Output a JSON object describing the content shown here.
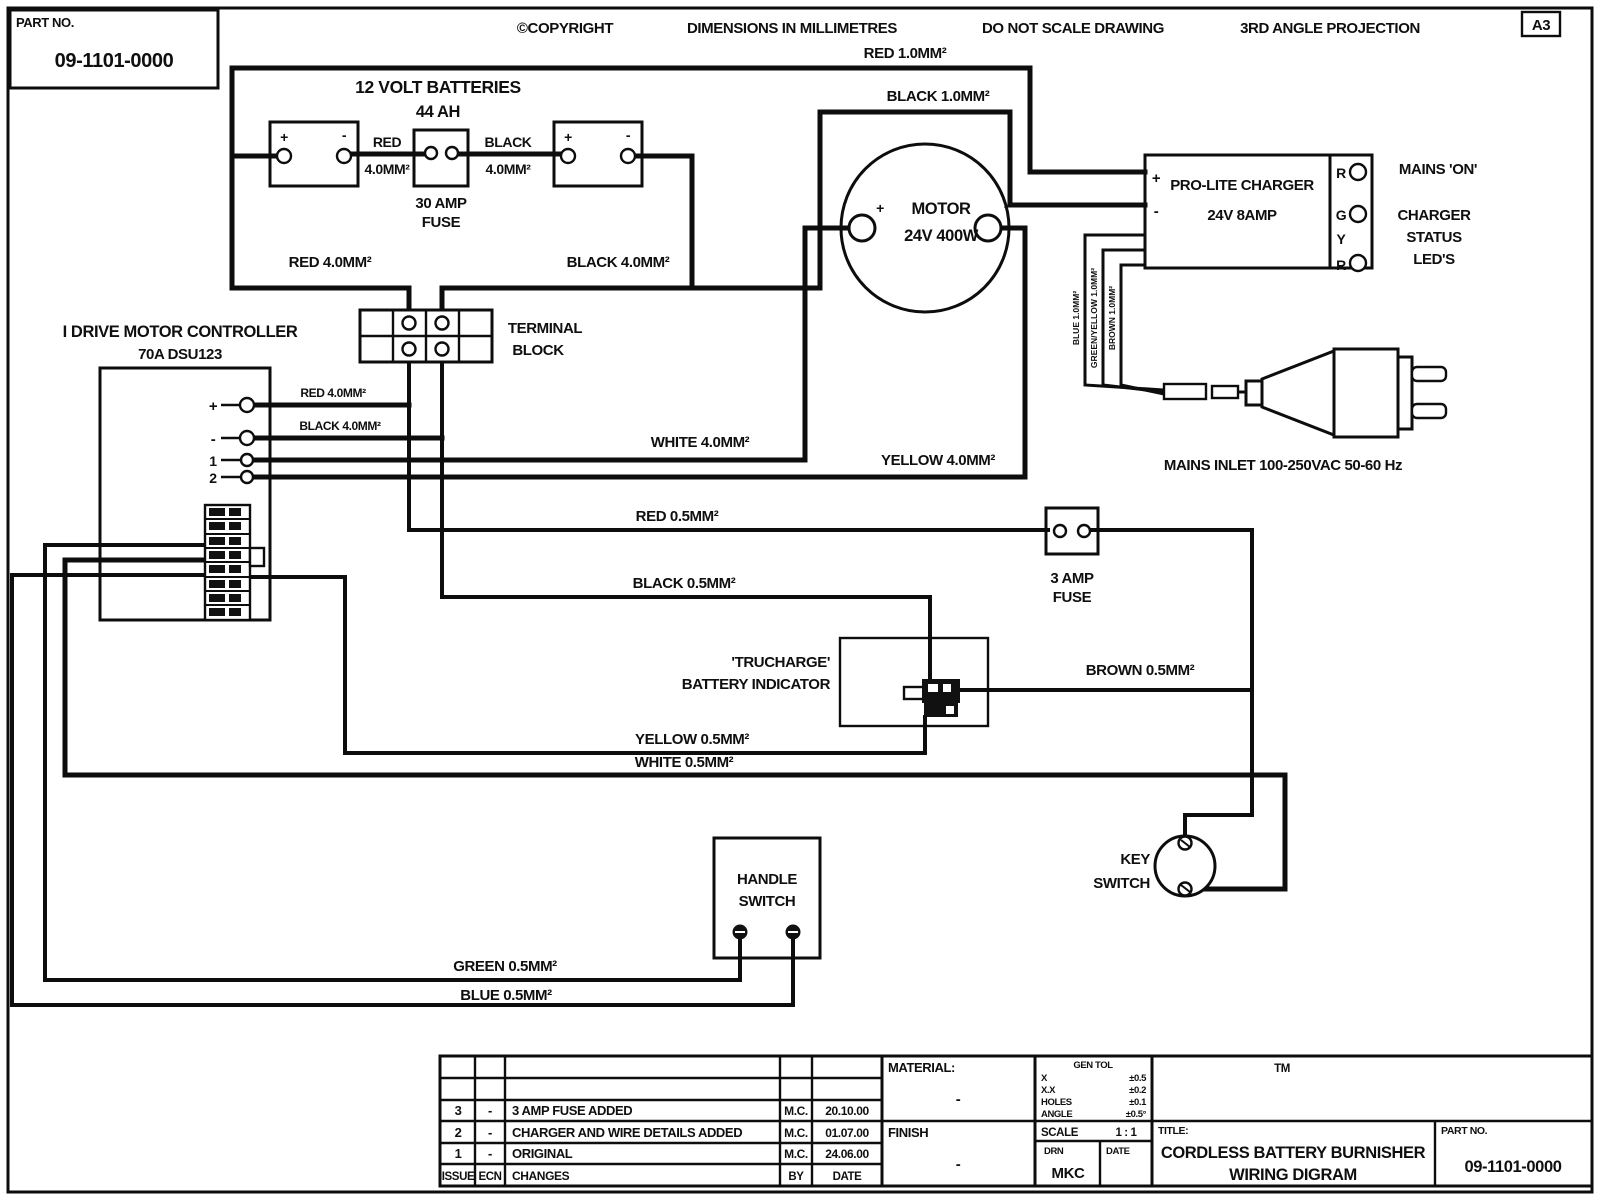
{
  "frame": {
    "part_no_label": "PART NO.",
    "part_no": "09-1101-0000",
    "copyright": "©COPYRIGHT",
    "dimensions": "DIMENSIONS IN MILLIMETRES",
    "no_scale": "DO NOT SCALE DRAWING",
    "projection": "3RD ANGLE PROJECTION",
    "sheet_size": "A3"
  },
  "batteries": {
    "title": "12 VOLT BATTERIES",
    "capacity": "44 AH",
    "plus": "+",
    "minus": "-",
    "fuse_line1": "30 AMP",
    "fuse_line2": "FUSE",
    "link_red": "RED",
    "link_red_size": "4.0MM²",
    "link_black": "BLACK",
    "link_black_size": "4.0MM²"
  },
  "controller": {
    "title": "I DRIVE MOTOR CONTROLLER",
    "subtitle": "70A DSU123",
    "t_plus": "+",
    "t_minus": "-",
    "t1": "1",
    "t2": "2"
  },
  "terminal_block": {
    "line1": "TERMINAL",
    "line2": "BLOCK"
  },
  "motor": {
    "name": "MOTOR",
    "rating": "24V 400W",
    "plus": "+",
    "minus": "-"
  },
  "charger": {
    "name": "PRO-LITE CHARGER",
    "rating": "24V 8AMP",
    "plus": "+",
    "minus": "-",
    "led1": "R",
    "led2": "G",
    "led3": "Y",
    "led4": "R",
    "mains_on": "MAINS 'ON'",
    "status1": "CHARGER",
    "status2": "STATUS",
    "status3": "LED'S"
  },
  "mains": {
    "inlet": "MAINS INLET 100-250VAC 50-60 Hz",
    "core1": "BLUE 1.0MM²",
    "core2": "GREEN/YELLOW 1.0MM²",
    "core3": "BROWN 1.0MM²"
  },
  "fuse3": {
    "line1": "3 AMP",
    "line2": "FUSE"
  },
  "indicator": {
    "line1": "'TRUCHARGE'",
    "line2": "BATTERY INDICATOR"
  },
  "handle_switch": {
    "line1": "HANDLE",
    "line2": "SWITCH"
  },
  "key_switch": {
    "line1": "KEY",
    "line2": "SWITCH"
  },
  "wires": {
    "red10": "RED 1.0MM²",
    "black10": "BLACK 1.0MM²",
    "red4_batt": "RED 4.0MM²",
    "black4_batt": "BLACK 4.0MM²",
    "red4_ctrl": "RED 4.0MM²",
    "black4_ctrl": "BLACK 4.0MM²",
    "white4": "WHITE 4.0MM²",
    "yellow4": "YELLOW 4.0MM²",
    "red05": "RED 0.5MM²",
    "black05": "BLACK 0.5MM²",
    "brown05": "BROWN 0.5MM²",
    "yellow05": "YELLOW 0.5MM²",
    "white05": "WHITE 0.5MM²",
    "green05": "GREEN 0.5MM²",
    "blue05": "BLUE 0.5MM²"
  },
  "title_block": {
    "headers": {
      "issue": "ISSUE",
      "ecn": "ECN",
      "changes": "CHANGES",
      "by": "BY",
      "date": "DATE"
    },
    "revisions": [
      {
        "issue": "3",
        "ecn": "-",
        "change": "3 AMP FUSE ADDED",
        "by": "M.C.",
        "date": "20.10.00"
      },
      {
        "issue": "2",
        "ecn": "-",
        "change": "CHARGER AND WIRE DETAILS ADDED",
        "by": "M.C.",
        "date": "01.07.00"
      },
      {
        "issue": "1",
        "ecn": "-",
        "change": "ORIGINAL",
        "by": "M.C.",
        "date": "24.06.00"
      }
    ],
    "material_label": "MATERIAL:",
    "material_value": "-",
    "finish_label": "FINISH",
    "finish_value": "-",
    "tol_header": "GEN TOL",
    "tol": [
      {
        "k": "X",
        "v": "±0.5"
      },
      {
        "k": "X.X",
        "v": "±0.2"
      },
      {
        "k": "HOLES",
        "v": "±0.1"
      },
      {
        "k": "ANGLE",
        "v": "±0.5°"
      }
    ],
    "scale_label": "SCALE",
    "scale_value": "1 : 1",
    "drn_label": "DRN",
    "drn_value": "MKC",
    "date_label": "DATE",
    "tm": "TM",
    "title_label": "TITLE:",
    "title_line1": "CORDLESS BATTERY BURNISHER",
    "title_line2": "WIRING DIGRAM",
    "part_label": "PART NO.",
    "part_no": "09-1101-0000"
  }
}
